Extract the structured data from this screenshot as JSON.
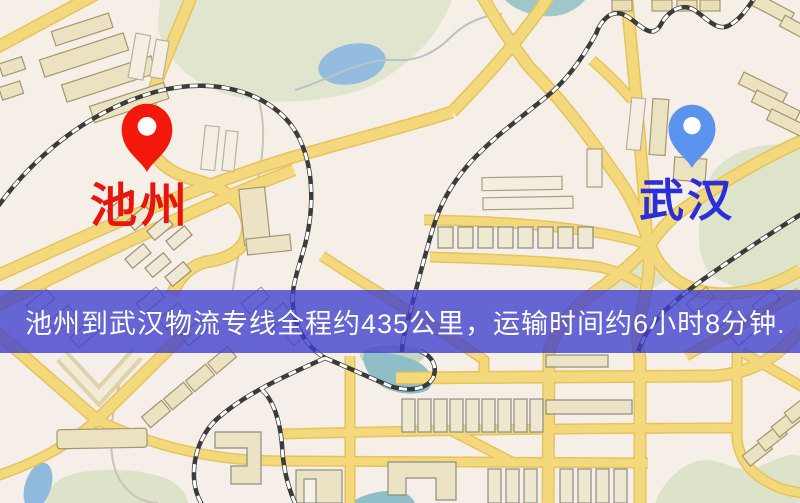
{
  "map": {
    "description": "road map background",
    "origin_marker": {
      "label": "池州",
      "label_color": "#e8150d",
      "pin_color": "#f2180c"
    },
    "destination_marker": {
      "label": "武汉",
      "label_color": "#2b2fd8",
      "pin_color": "#5b93ee"
    },
    "palette": {
      "background": "#f5efe7",
      "road_fill": "#f4d87c",
      "road_casing": "#e6c35e",
      "park_green": "#e0e6cd",
      "water_blue": "#93bce0",
      "building_fill": "#ebe2c2",
      "railway_dark": "#3b3b3b"
    }
  },
  "banner": {
    "text": "池州到武汉物流专线全程约435公里，运输时间约6小时8分钟.",
    "bg_color": "rgba(62,62,206,0.78)",
    "text_color": "#ffffff",
    "route": {
      "from": "池州",
      "to": "武汉",
      "service": "物流专线",
      "distance": "约435公里",
      "duration": "约6小时8分钟"
    }
  }
}
